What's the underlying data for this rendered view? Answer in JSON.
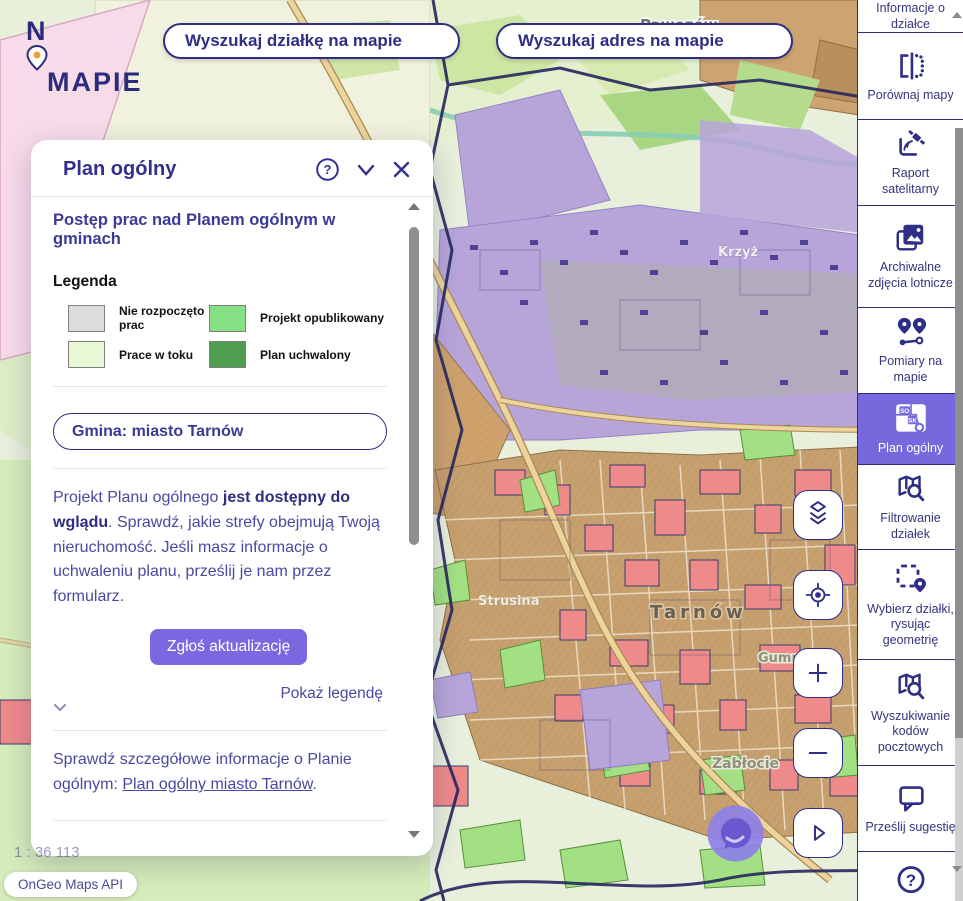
{
  "brand": {
    "n": "N",
    "mapie": "MAPIE"
  },
  "search": {
    "parcel": "Wyszukaj działkę na mapie",
    "address": "Wyszukaj adres na mapie"
  },
  "panel": {
    "title": "Plan ogólny",
    "heading": "Postęp prac nad Planem ogólnym w gminach",
    "legend": {
      "title": "Legenda",
      "items": [
        {
          "label": "Nie rozpoczęto prac",
          "color": "#dcdcdc"
        },
        {
          "label": "Projekt opublikowany",
          "color": "#86e084"
        },
        {
          "label": "Prace w toku",
          "color": "#e9f9d8"
        },
        {
          "label": "Plan uchwalony",
          "color": "#4f9e4f"
        }
      ]
    },
    "gmina": "Gmina: miasto Tarnów",
    "p1": {
      "pre": "Projekt Planu ogólnego ",
      "bold": "jest dostępny do wglądu",
      "post": ". Sprawdź, jakie strefy obejmują Twoją nieruchomość. Jeśli masz informacje o uchwaleniu planu, prześlij je nam przez formularz."
    },
    "update_button": "Zgłoś aktualizację",
    "show_legend": "Pokaż legendę",
    "p2": {
      "pre": "Sprawdź szczegółowe informacje o Planie ogólnym: ",
      "link": "Plan ogólny miasto Tarnów",
      "post": "."
    },
    "p3": {
      "pre": "Złóż wniosek do Planu ogólnego, zadbaj o wspólną przestrzeń ",
      "link": "Pobierz formularz wniosku ",
      "post": ", w której są formularze do"
    }
  },
  "sidebar": {
    "items": [
      {
        "label": "Informacje o działce"
      },
      {
        "label": "Porównaj mapy"
      },
      {
        "label": "Raport satelitarny"
      },
      {
        "label": "Archiwalne zdjęcia lotnicze"
      },
      {
        "label": "Pomiary na mapie"
      },
      {
        "label": "Plan ogólny",
        "selected": true,
        "badge_so": "SO",
        "badge_sk": "SK"
      },
      {
        "label": "Filtrowanie działek"
      },
      {
        "label": "Wybierz działki, rysując geometrię"
      },
      {
        "label": "Wyszukiwanie kodów pocztowych"
      },
      {
        "label": "Prześlij sugestię"
      },
      {
        "label": ""
      }
    ]
  },
  "map": {
    "labels": {
      "pawezow": "Pawęzów",
      "krzyz": "Krzyż",
      "klikowa": "Klikowa",
      "strusina": "Strusina",
      "tarnow": "Tarnów",
      "zablocie": "Zabłocie",
      "gumniska": "Gumniska"
    },
    "scale": "1 : 36 113",
    "attribution": "OnGeo Maps API"
  },
  "colors": {
    "accent_purple": "#7b68e0",
    "navy": "#2e2e85",
    "selected_sidebar": "#7668dd"
  }
}
